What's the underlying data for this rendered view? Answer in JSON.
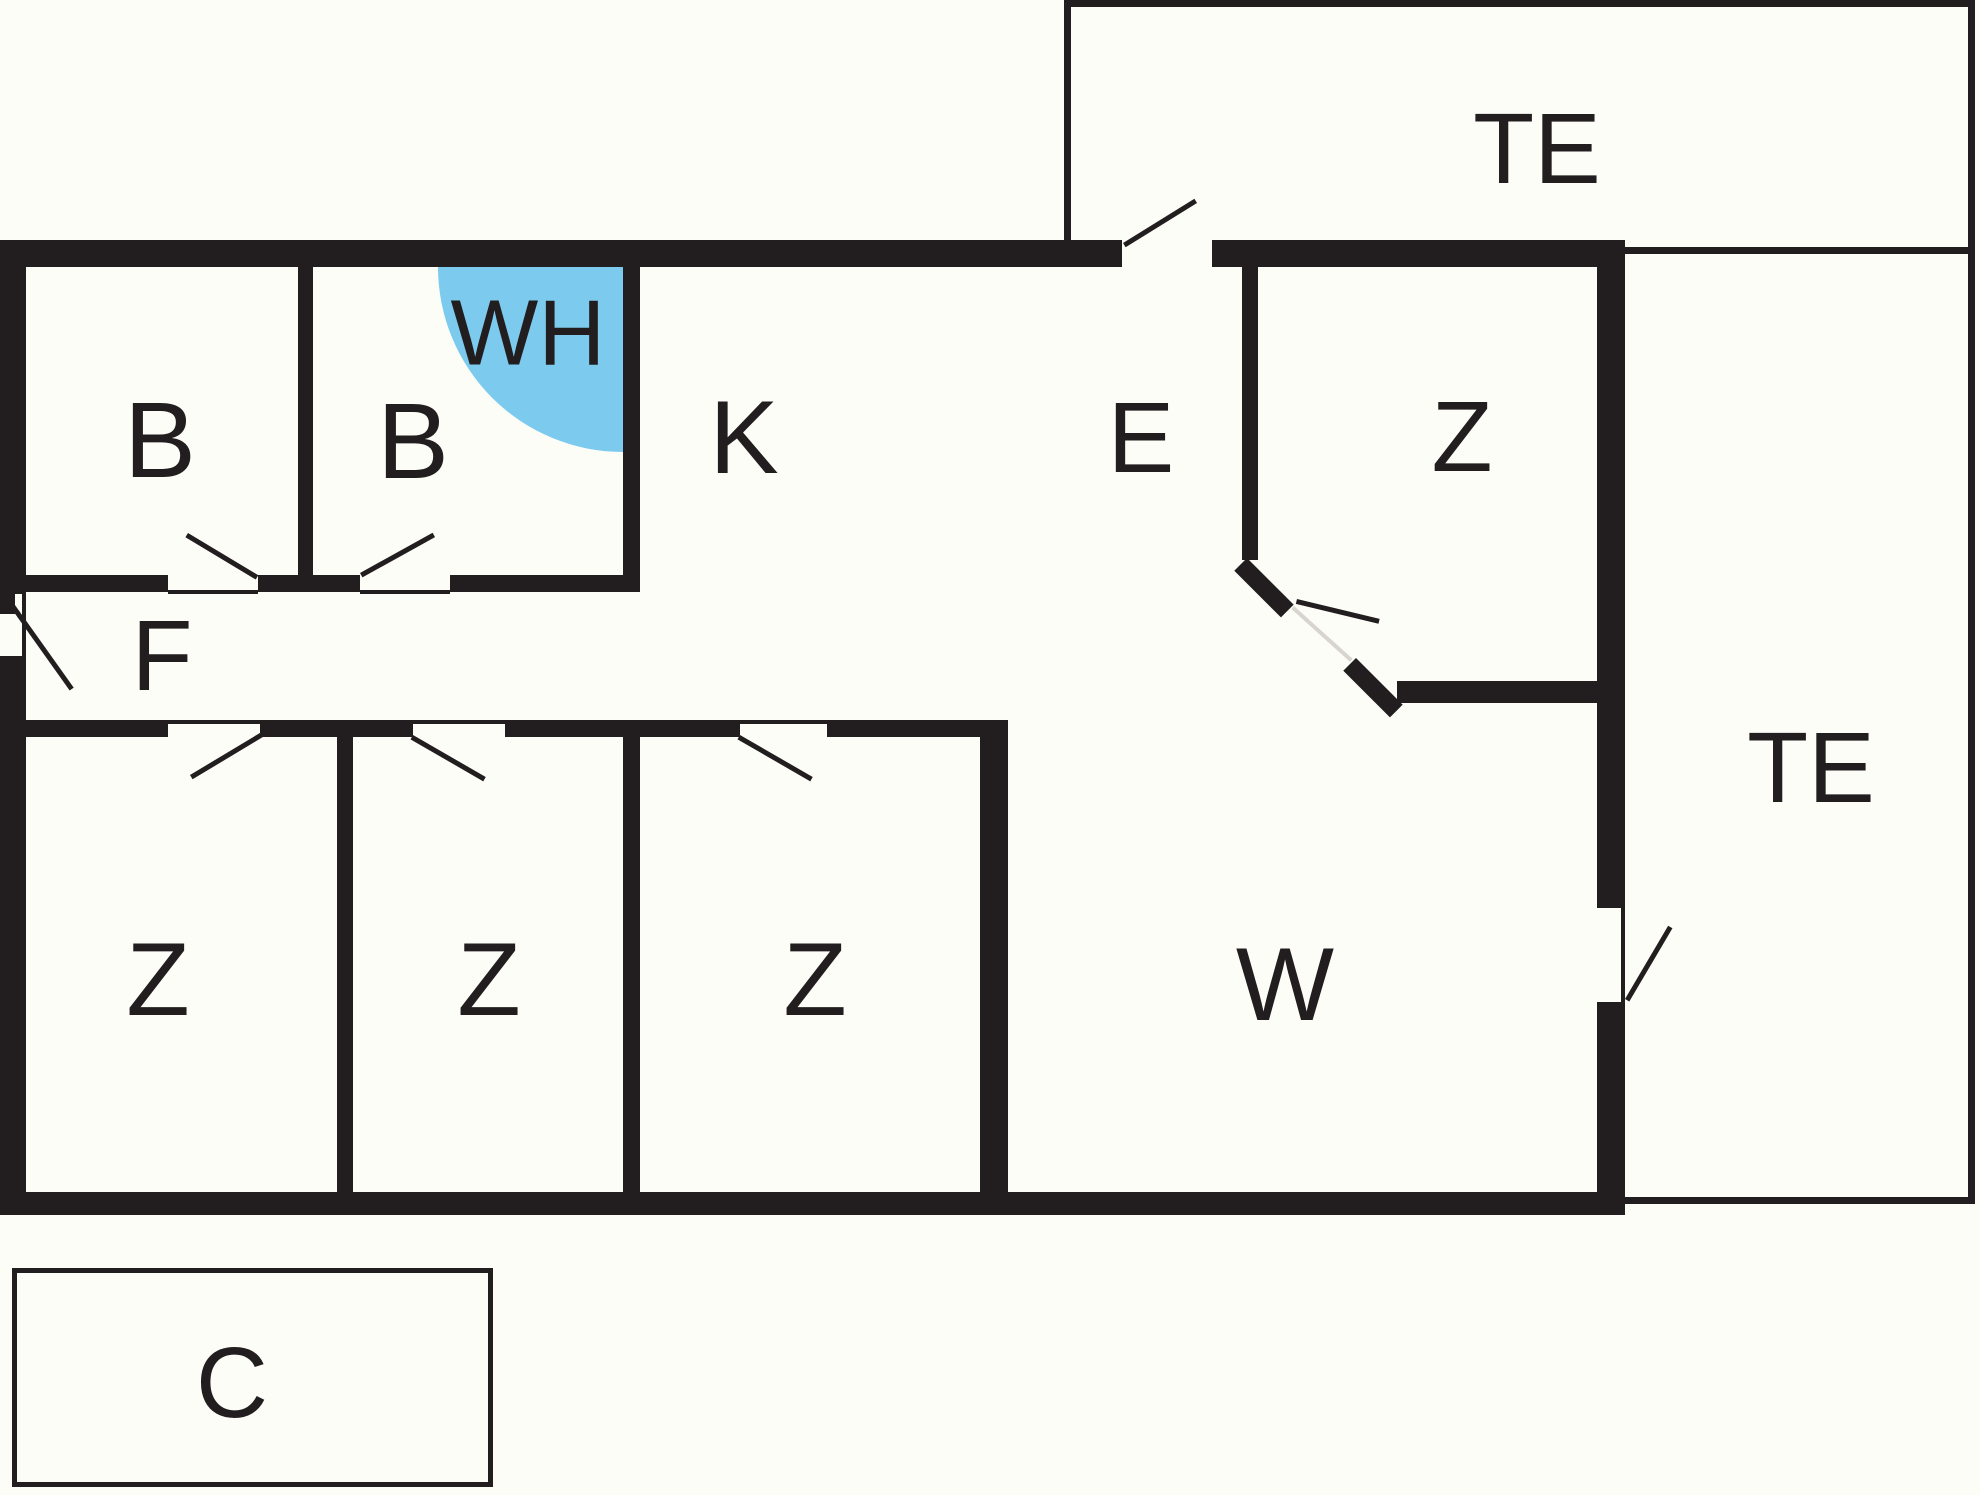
{
  "plan": {
    "type": "floor-plan",
    "colors": {
      "wall": "#221E1F",
      "floor": "#FDFDF8",
      "water_heater_highlight": "#7CCBEE",
      "door_leaf": "#D8D5CF"
    },
    "labels": {
      "terrace_top": "TE",
      "terrace_right": "TE",
      "bathroom_1": "B",
      "bathroom_2": "B",
      "water_heater": "WH",
      "kitchen": "K",
      "entry": "E",
      "bedroom_upper": "Z",
      "hallway": "F",
      "bedroom_1": "Z",
      "bedroom_2": "Z",
      "bedroom_3": "Z",
      "living_room": "W",
      "carport": "C"
    }
  }
}
